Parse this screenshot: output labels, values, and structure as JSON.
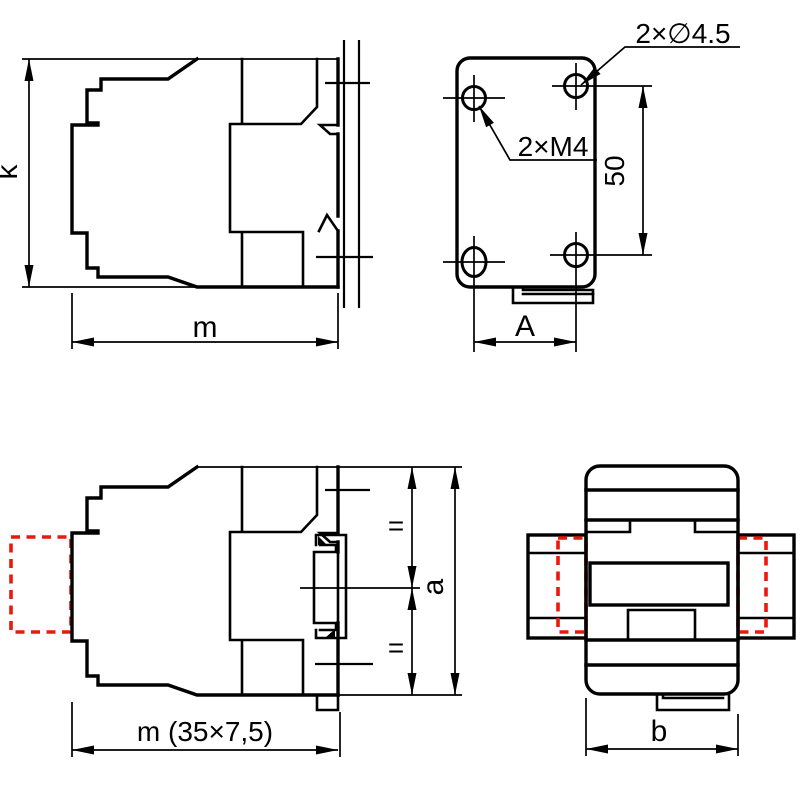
{
  "drawing": {
    "colors": {
      "line": "#000000",
      "accessory_dashed": "#e8190d",
      "background": "#ffffff"
    },
    "views": {
      "side_top": {
        "labels": {
          "k": "k",
          "m": "m"
        }
      },
      "mounting_plate": {
        "labels": {
          "holes_dia": "2×∅4.5",
          "holes_thread": "2×M4",
          "vertical_spacing": "50",
          "horizontal_spacing": "A"
        }
      },
      "side_bottom": {
        "labels": {
          "equal_top": "=",
          "equal_bottom": "=",
          "height": "a",
          "rail_width": "m (35×7,5)"
        }
      },
      "top_view": {
        "labels": {
          "width": "b"
        }
      }
    }
  }
}
